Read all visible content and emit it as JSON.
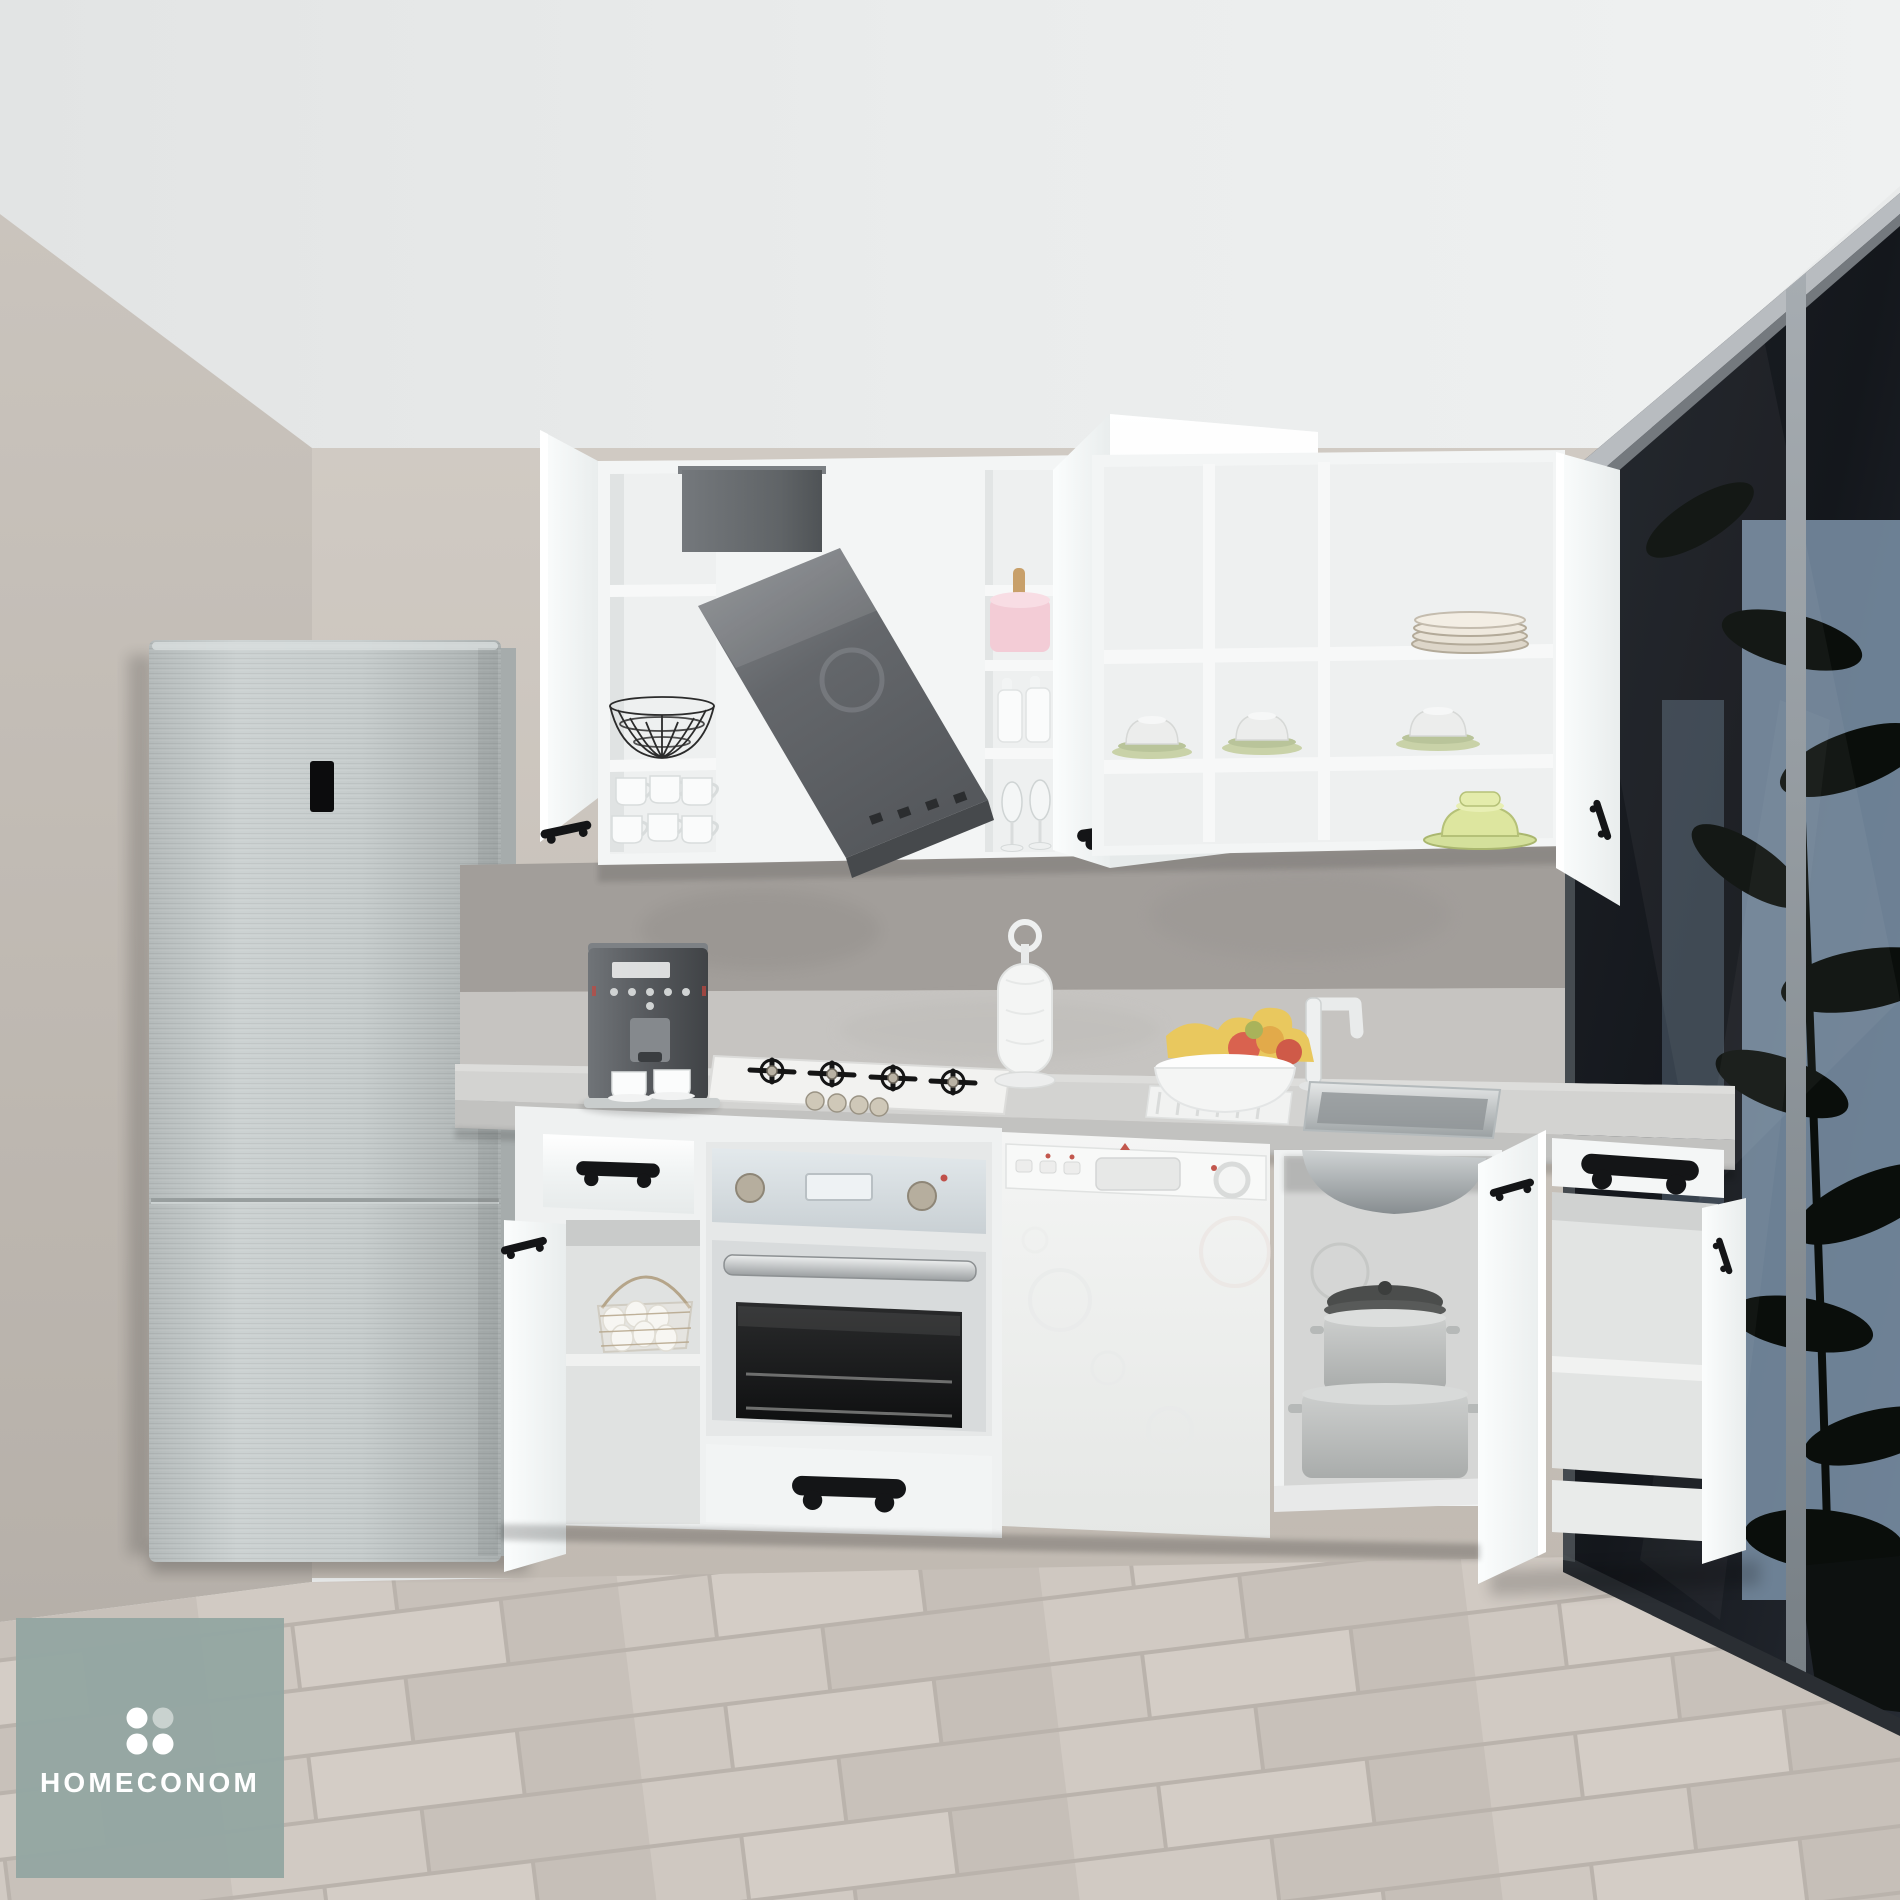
{
  "watermark": {
    "brand": "HOMECONOM",
    "logo_icon": "four-dots-logo"
  },
  "colors": {
    "ceiling": "#e9ebeb",
    "wall_left": "#c7c1ba",
    "wall_back": "#cdc7c0",
    "floor": "#ccc5be",
    "cabinet": "#f3f5f5",
    "counter": "#d3d3d1",
    "backsplash_dark": "#a29e9a",
    "backsplash_light": "#c6c4c1",
    "steel": "#c4caca",
    "hood": "#64686c",
    "glass_partition": "#171b21",
    "sky": "#7b92a8",
    "plant": "#0a0e0b",
    "handle": "#141517",
    "towel_pink": "#f3ccd6",
    "banana": "#e9c85e",
    "apple": "#d9624f",
    "green_dish": "#d4e09b",
    "logo_bg": "#94a6a2",
    "logo_text": "#ffffff",
    "logo_dot_light": "#c9d2cf"
  }
}
